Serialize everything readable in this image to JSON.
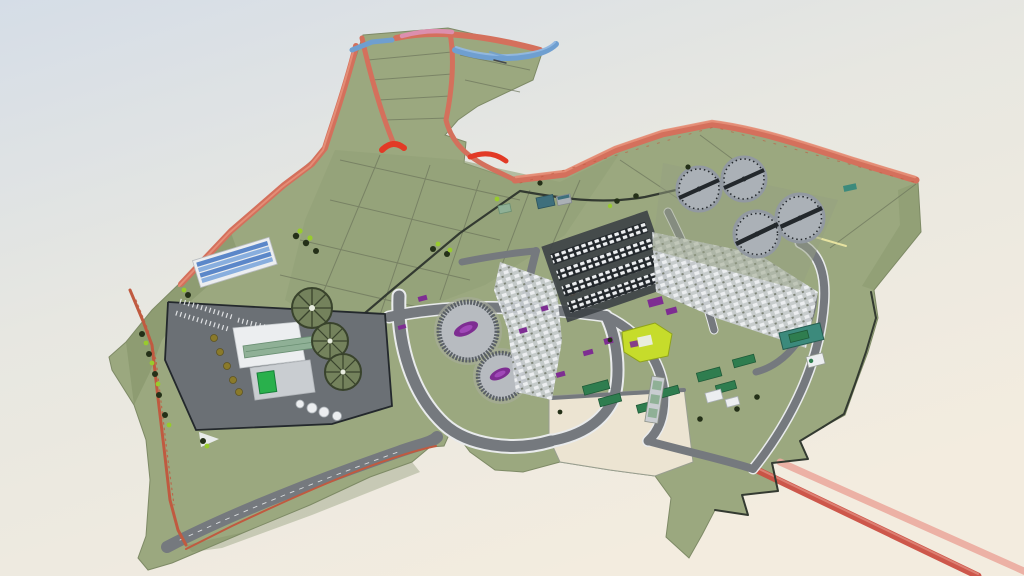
{
  "meta": {
    "app": "3d-site-model-viewer",
    "description": "Aerial 3D rendering of a wastewater treatment plant site model with green terrain, red boundary berms, process compounds, circular clarifier tanks and outfall pipelines on a gradient sky background"
  },
  "palette": {
    "bgTop": "#d5dde7",
    "bgMid": "#e7e7e1",
    "bgBottom": "#f3ecdf",
    "terrain": "#9ba87f",
    "terrainField": "#91a077",
    "terrainSlope": "#7f8d63",
    "parcelLine": "#6d755c",
    "beige": "#ece4d2",
    "berm": "#d4705c",
    "bermLight": "#e59079",
    "bermBright": "#e23a26",
    "bermPink": "#dc8fae",
    "boundaryRed": "#c05a40",
    "water": "#6f9fd0",
    "waterLight": "#93b9e2",
    "road": "#75797e",
    "roadDark": "#5f6368",
    "roadEdge": "#e9ebec",
    "pavement": "#6b7075",
    "pavementDark": "#3e4347",
    "white": "#eceef0",
    "whiteShade": "#c9cdd1",
    "structGray": "#aab0b5",
    "hedge": "#333a31",
    "fence": "#23282c",
    "treeDark": "#243018",
    "treeLime": "#98cb2d",
    "clarifier": "#abb1b7",
    "clarifierShade": "#9299a1",
    "bridge": "#23282c",
    "tankTop": "#b7bbc0",
    "tankWall": "#5a6066",
    "purple": "#7e2d92",
    "purpleLight": "#a048b8",
    "lime": "#c6dc2b",
    "greenBldg": "#29b04c",
    "greenRoof": "#8fb096",
    "teal": "#3c8a7c",
    "container": "#2f7d4f",
    "solar": "#5b87c9",
    "solarLight": "#88aede",
    "olive": "#8a7a2a",
    "orange": "#e08820",
    "yellowLine": "#e6e2a0",
    "pipe": "#cb5044",
    "pipeLight": "#ecab9f",
    "radialTank": "#74825c",
    "radialDark": "#39432c"
  },
  "scene": {
    "view": {
      "width": 1024,
      "height": 576
    },
    "inventory": [
      {
        "id": "site-terrain",
        "label": "green site terrain with field parcels"
      },
      {
        "id": "boundary-berm",
        "label": "salmon red perimeter berm"
      },
      {
        "id": "water-channel",
        "label": "blue canal ribbons at north edge"
      },
      {
        "id": "clarifier-tanks",
        "label": "four circular clarifiers with scraper bridges",
        "count": 4
      },
      {
        "id": "digester-tanks",
        "label": "two circular tanks with purple mixers",
        "count": 2
      },
      {
        "id": "radial-tanks",
        "label": "three radial-spoke process tanks",
        "count": 3
      },
      {
        "id": "aeration-basins",
        "label": "four covered aeration basin trains",
        "count": 4
      },
      {
        "id": "solar-roof-building",
        "label": "admin building with blue PV roof"
      },
      {
        "id": "process-compound",
        "label": "paved process compound with white buildings"
      },
      {
        "id": "expansion-plot",
        "label": "beige future expansion plot"
      },
      {
        "id": "outfall-pipelines",
        "label": "two red outfall pipelines",
        "count": 2
      }
    ]
  }
}
